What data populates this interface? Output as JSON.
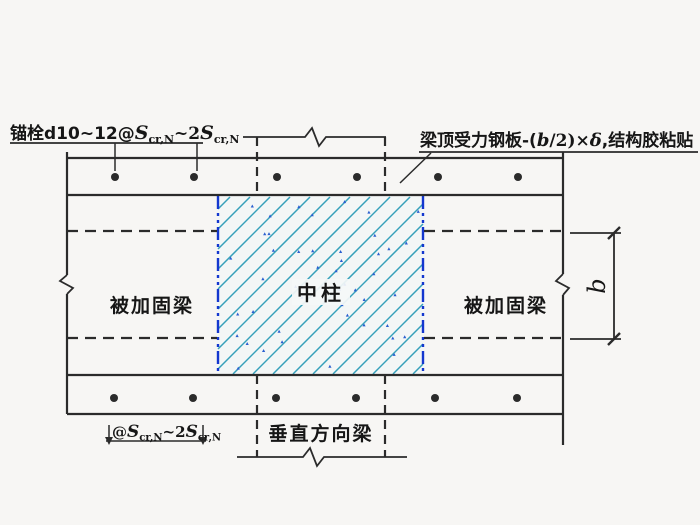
{
  "labels": {
    "anchor": {
      "prefix": "锚栓d10~12@",
      "s1": "S",
      "sub1": "cr,N",
      "mid": "~2",
      "s2": "S",
      "sub2": "cr,N"
    },
    "plate": {
      "p1": "梁顶受力钢板-(",
      "b": "b",
      "p2": "/2)×",
      "delta": "δ",
      "p3": ",结构胶粘贴"
    },
    "beam_left": "被加固梁",
    "beam_right": "被加固梁",
    "column": "中柱",
    "perp_beam": "垂直方向梁",
    "spacing": {
      "prefix": "@",
      "s1": "S",
      "sub1": "cr,N",
      "mid": "~2",
      "s2": "S",
      "sub2": "cr,N"
    },
    "dim_b": "b"
  },
  "colors": {
    "line": "#2b2b2b",
    "text": "#161616",
    "hatch": "#36a0ba",
    "column_edge": "#1437cf",
    "speckle": "#2a5fd0",
    "paper": "#f7f6f4",
    "column_bg": "#f3f6f6"
  }
}
